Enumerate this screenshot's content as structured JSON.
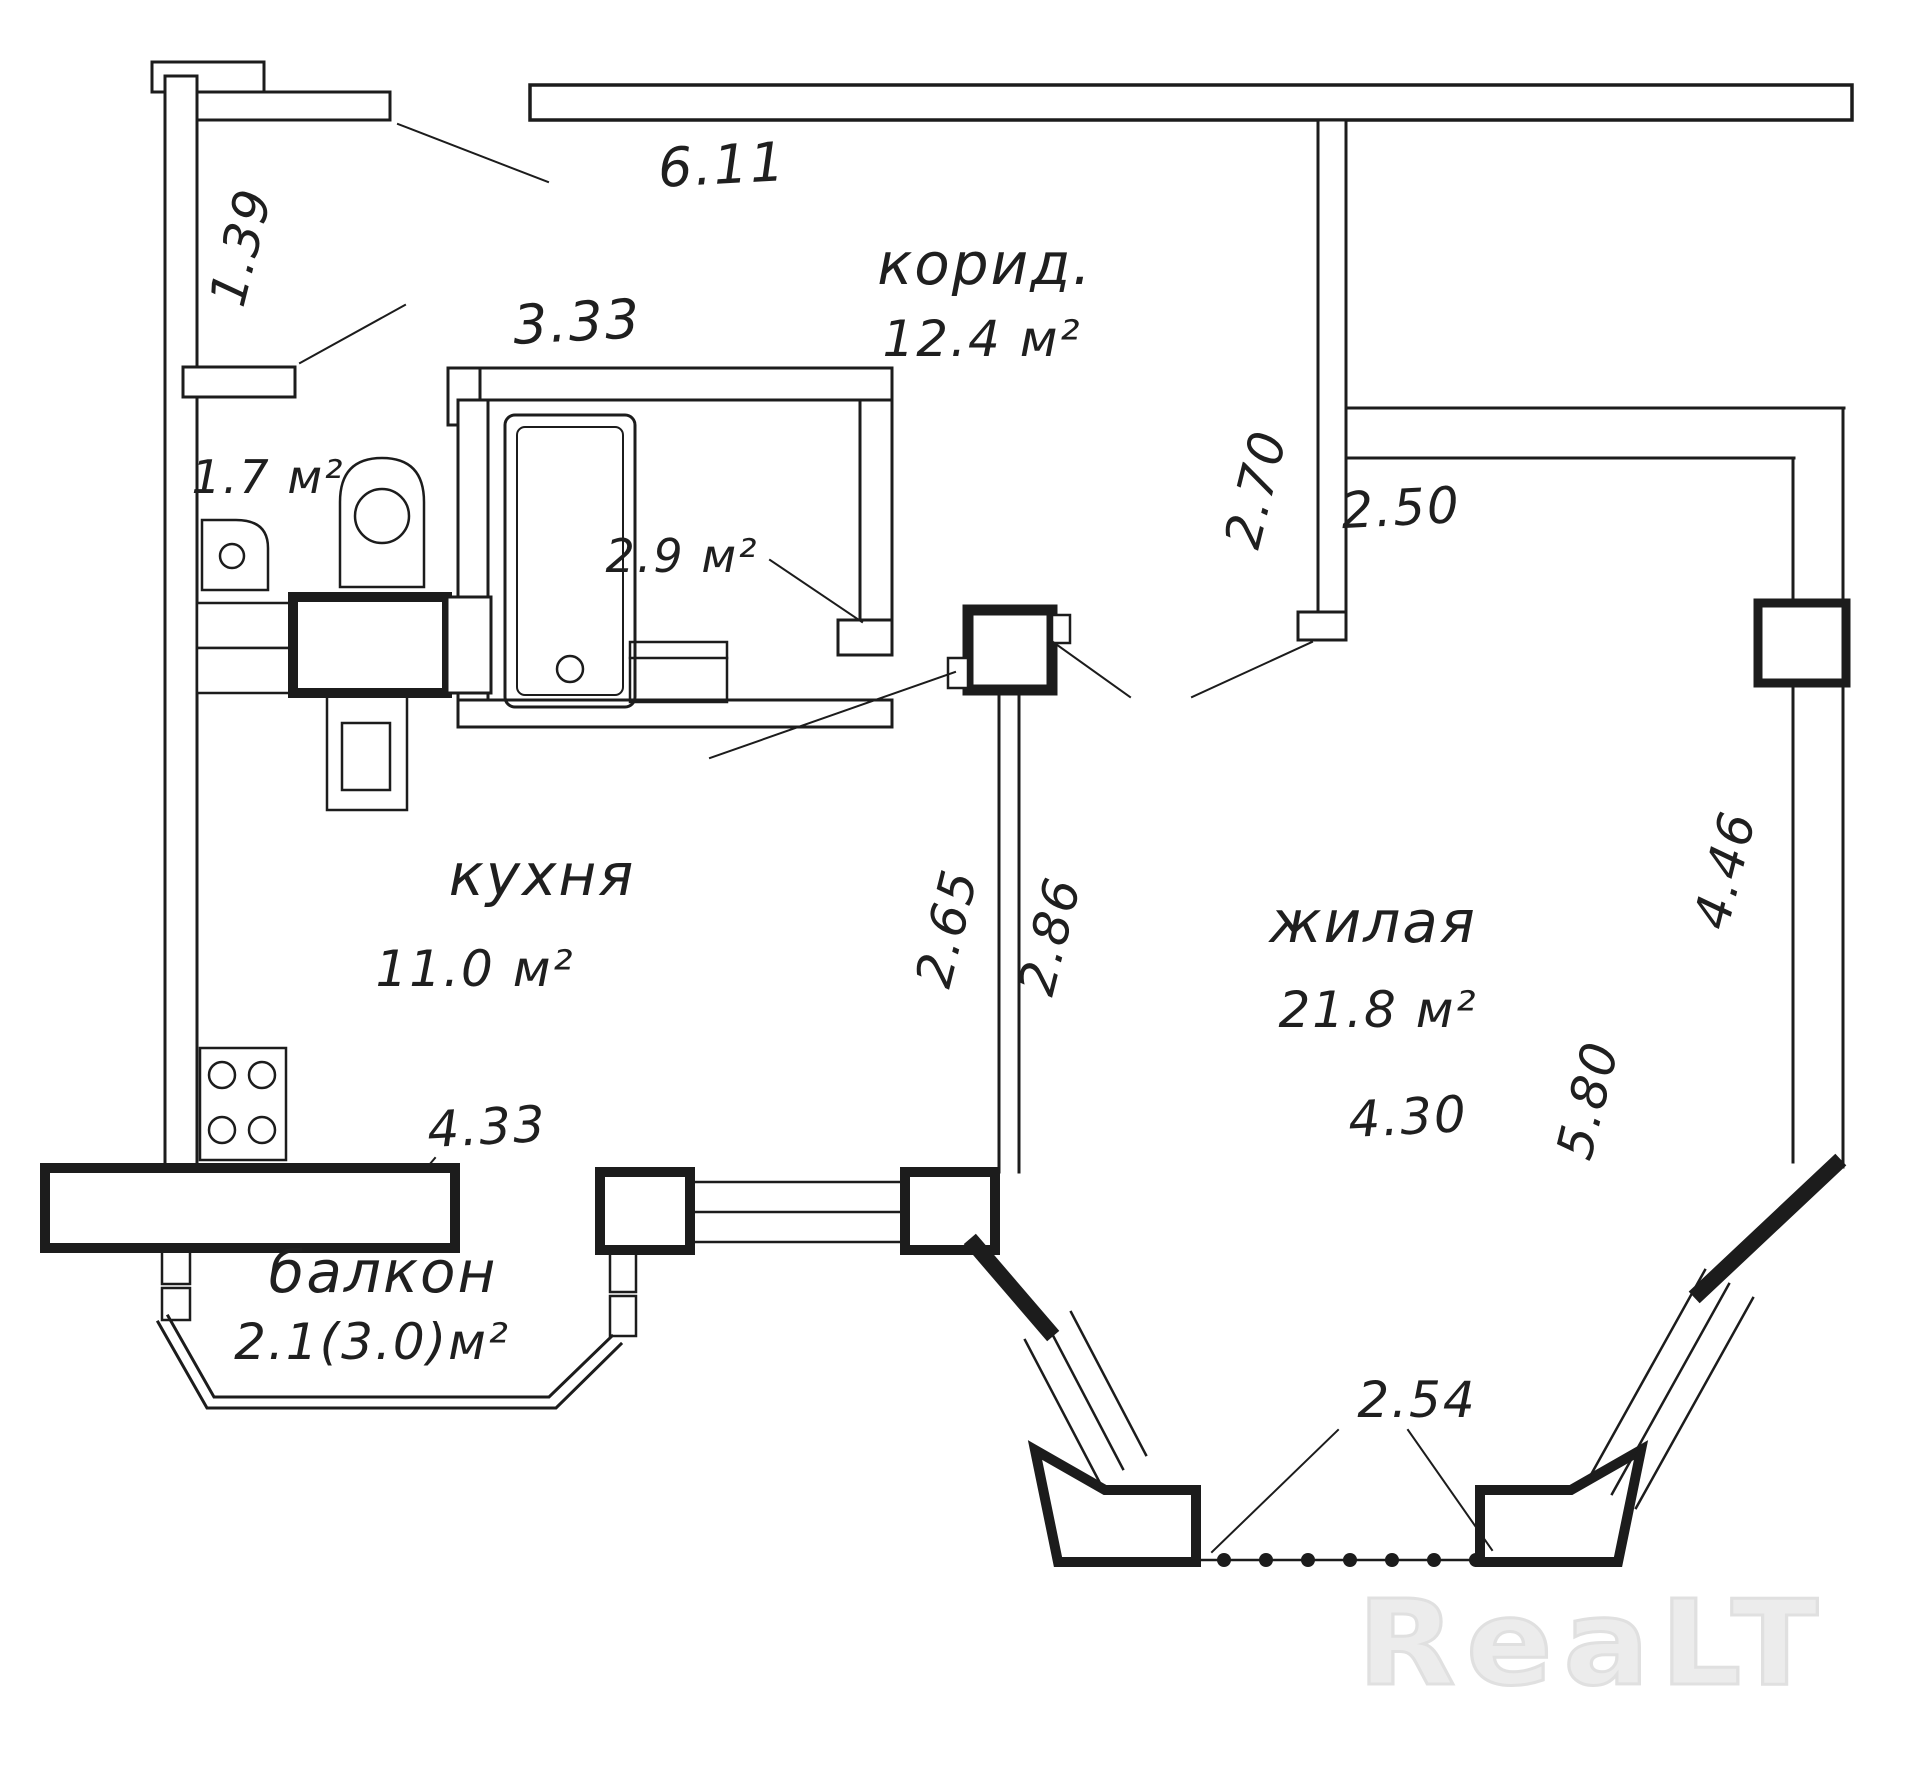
{
  "watermark": {
    "text": "ReaLT"
  },
  "rooms": {
    "corridor": {
      "name": "корид.",
      "area": "12.4 м²"
    },
    "kitchen": {
      "name": "кухня",
      "area": "11.0 м²"
    },
    "living": {
      "name": "жилая",
      "area": "21.8 м²"
    },
    "balcony": {
      "name": "балкон",
      "area": "2.1(3.0)м²"
    },
    "wc": {
      "area": "1.7 м²"
    },
    "bathroom": {
      "area": "2.9 м²"
    }
  },
  "dimensions": {
    "top_wall": "6.11",
    "entry_left": "1.39",
    "bath_top": "3.33",
    "corridor_divider": "2.70",
    "living_top": "2.50",
    "partition_kitchen": "2.65",
    "partition_living": "2.86",
    "living_right": "4.46",
    "living_left": "5.80",
    "living_width": "4.30",
    "kitchen_window": "4.33",
    "bay_front": "2.54"
  },
  "colors": {
    "ink": "#1c1c1c",
    "watermark": "#e3e3e3"
  }
}
